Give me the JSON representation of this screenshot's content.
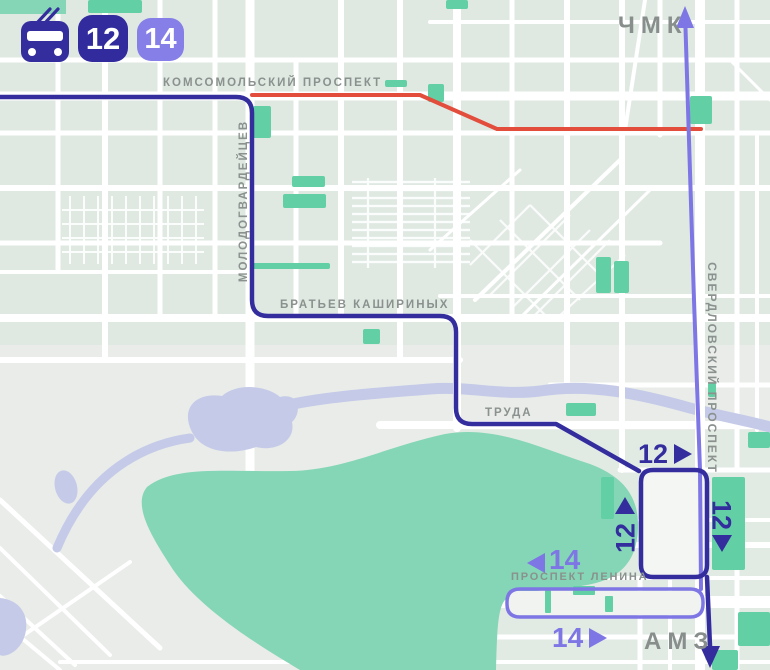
{
  "header": {
    "transport_icon": "trolleybus-icon",
    "routes": [
      {
        "number": "12",
        "color": "#312b9d"
      },
      {
        "number": "14",
        "color": "#867fe8"
      }
    ]
  },
  "map": {
    "street_labels": [
      {
        "id": "komsomolsky",
        "text": "КОМСОМОЛЬСКИЙ ПРОСПЕКТ",
        "orientation": "horizontal"
      },
      {
        "id": "molodogvardeytsev",
        "text": "МОЛОДОГВАРДЕЙЦЕВ",
        "orientation": "vertical"
      },
      {
        "id": "bratyev-kashirinykh",
        "text": "БРАТЬЕВ КАШИРИНЫХ",
        "orientation": "horizontal"
      },
      {
        "id": "truda",
        "text": "ТРУДА",
        "orientation": "horizontal"
      },
      {
        "id": "sverdlovsky",
        "text": "СВЕРДЛОВСКИЙ ПРОСПЕКТ",
        "orientation": "vertical"
      },
      {
        "id": "lenina",
        "text": "ПРОСПЕКТ ЛЕНИНА",
        "orientation": "horizontal"
      }
    ],
    "termini": [
      {
        "id": "north",
        "text": "ЧМК"
      },
      {
        "id": "south",
        "text": "АМЗ"
      }
    ],
    "route_markers": [
      {
        "route": "12",
        "direction": "right",
        "location": "loop-top"
      },
      {
        "route": "12",
        "direction": "up",
        "location": "loop-left"
      },
      {
        "route": "12",
        "direction": "down",
        "location": "loop-right"
      },
      {
        "route": "14",
        "direction": "left",
        "location": "lenina-west"
      },
      {
        "route": "14",
        "direction": "right",
        "location": "lenina-east"
      }
    ],
    "colors": {
      "route_12": "#332d9e",
      "route_14": "#7d76e4",
      "badge_12": "#312b9d",
      "badge_14": "#867fe8",
      "closed_segment": "#e24d3c",
      "street_label": "#8a918e",
      "terminus_label": "#878e8c",
      "park": "#85d6b6",
      "green_area": "#62d0a4",
      "water": "#c5cae8",
      "city_block": "#dfe9e2",
      "background": "#e9ece9",
      "road": "#ffffff"
    }
  }
}
